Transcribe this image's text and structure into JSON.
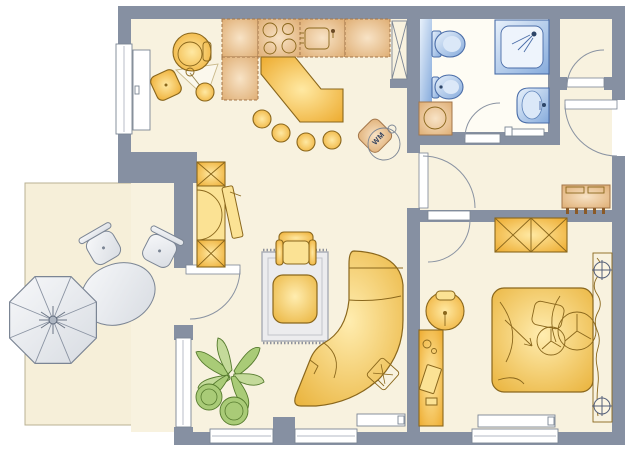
{
  "labels": {
    "washing_machine": "WM"
  },
  "colors": {
    "wall": "#8690a2",
    "floor": "#f8f2df",
    "bath_floor": "#fefcf4",
    "terrace": "#f6efd9",
    "terrace_edge": "#b9b193",
    "furniture_outline": "#8a671c",
    "counter_outline": "#a3764a",
    "bath_outline": "#4a6da8",
    "gray_outline": "#7b8594",
    "plant": "#a9cb77",
    "plant_outline": "#567b2e",
    "rug": "#ececee",
    "rug_outline": "#a9acb4",
    "text": "#33425e"
  },
  "floorplan": {
    "type": "apartment-floor-plan",
    "rooms": [
      {
        "name": "kitchen-dining",
        "furniture": [
          "kitchen-counter",
          "stove",
          "kitchen-sink",
          "bar-counter",
          "bar-stools",
          "dining-table",
          "dining-chairs",
          "tall-cabinet",
          "washing-machine-marker"
        ]
      },
      {
        "name": "bathroom",
        "furniture": [
          "toilet",
          "bidet",
          "shower",
          "washbasin",
          "washing-machine",
          "towel-rail"
        ]
      },
      {
        "name": "hallway",
        "furniture": [
          "sideboard",
          "entrance-door"
        ]
      },
      {
        "name": "storage-room",
        "furniture": []
      },
      {
        "name": "living-room",
        "furniture": [
          "shelf-unit",
          "tv-panel",
          "rug",
          "coffee-table",
          "armchair",
          "corner-sofa",
          "cushion",
          "plant",
          "radiator"
        ]
      },
      {
        "name": "bedroom",
        "furniture": [
          "wardrobe",
          "double-bed",
          "pillows",
          "headboard",
          "bedside-lamps",
          "desk",
          "desk-chair",
          "radiator"
        ]
      },
      {
        "name": "terrace",
        "furniture": [
          "parasol",
          "garden-table",
          "garden-chairs"
        ]
      }
    ]
  }
}
